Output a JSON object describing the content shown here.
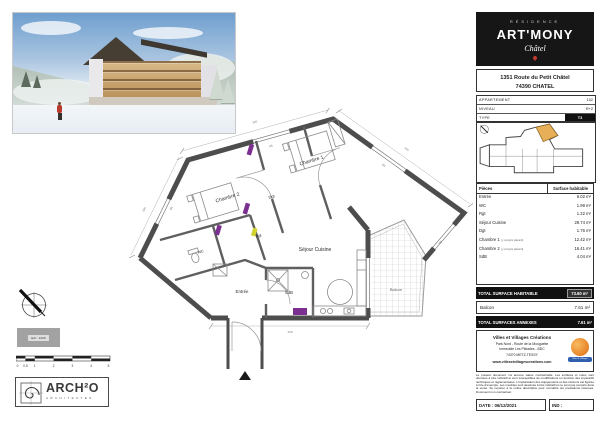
{
  "colors": {
    "brand_black": "#161616",
    "unit_highlight_orange": "#e7b058",
    "door_marker_purple": "#7b2f8e",
    "door_marker_yellow": "#d4d22e",
    "promoter_logo_orange": "#e8872b",
    "promoter_ribbon_blue": "#2f5fae",
    "pin_red": "#c0392b"
  },
  "header": {
    "residence": "RÉSIDENCE",
    "name": "ART'MONY",
    "place": "Châtel",
    "address1": "1351 Route du Petit Châtel",
    "address2": "74390 CHATEL"
  },
  "info_table": {
    "rows": [
      {
        "label": "APPARTEMENT",
        "value": "102"
      },
      {
        "label": "NIVEAU",
        "value": "R+2"
      },
      {
        "label": "TYPE",
        "value": "T3"
      }
    ]
  },
  "surface_table": {
    "col_piece": "Pièces",
    "col_surface": "Surface habitable",
    "rows": [
      {
        "label": "Entrée",
        "note": "",
        "value": "6.02 m²"
      },
      {
        "label": "WC",
        "note": "",
        "value": "1.99 m²"
      },
      {
        "label": "Rgt",
        "note": "",
        "value": "1.22 m²"
      },
      {
        "label": "Séjour Cuisine",
        "note": "",
        "value": "29.74 m²"
      },
      {
        "label": "Dgt",
        "note": "",
        "value": "1.76 m²"
      },
      {
        "label": "Chambre 1",
        "note": "(y compris placard)",
        "value": "12.42 m²"
      },
      {
        "label": "Chambre 2",
        "note": "(y compris placard)",
        "value": "16.41 m²"
      },
      {
        "label": "SdB",
        "note": "",
        "value": "4.04 m²"
      }
    ],
    "total_label": "TOTAL SURFACE HABITABLE",
    "total_value": "73.60 m²",
    "balcon_label": "Balcon",
    "balcon_value": "7.61 m²",
    "annex_label": "TOTAL SURFACES ANNEXES",
    "annex_value": "7.61 m²"
  },
  "plan": {
    "rooms": {
      "chambre1": "Chambre 1",
      "chambre2": "Chambre 2",
      "dgt": "Dgt",
      "sejour": "Séjour Cuisine",
      "entree": "Entrée",
      "sdb": "SdB",
      "wc": "WC",
      "rgt": "Rgt",
      "balcon": "Balcon"
    },
    "window_tag": "VR",
    "dims": [
      "398",
      "445",
      "290",
      "368"
    ]
  },
  "promoter": {
    "name": "Villes et Villages Créations",
    "address1": "Park Nord - Route de la Mouguette",
    "address2": "Immeuble Les Pléiades - BDC",
    "address3": "74370 METZ-TESSY",
    "website": "www.villesetvillagescreations.com",
    "ribbon": "Villes & Villages",
    "legal": "Le présent document n'a aucune valeur contractuelle. Les surfaces et cotes sont données à titre indicatif et sont susceptibles de modifications en fonction des impératifs techniques et réglementaires. L'implantation des équipements et des cloisons est figurée à titre d'exemple. Les meubles sont dessinés à titre indicatif et ne sont pas compris dans la vente. Se reporter à la notice descriptive pour connaître les prestations retenues. Document non contractuel."
  },
  "footer": {
    "date_label": "DATE :",
    "date_value": "06/12/2021",
    "ind_label": "IND :"
  },
  "scalebar": {
    "ticks": [
      "0",
      "0.5",
      "1",
      "2",
      "3",
      "4",
      "5"
    ],
    "scale_note": "Ech : 1/100"
  },
  "architect": {
    "name": "ARCH²O",
    "subtitle": "ARCHITECTES"
  }
}
